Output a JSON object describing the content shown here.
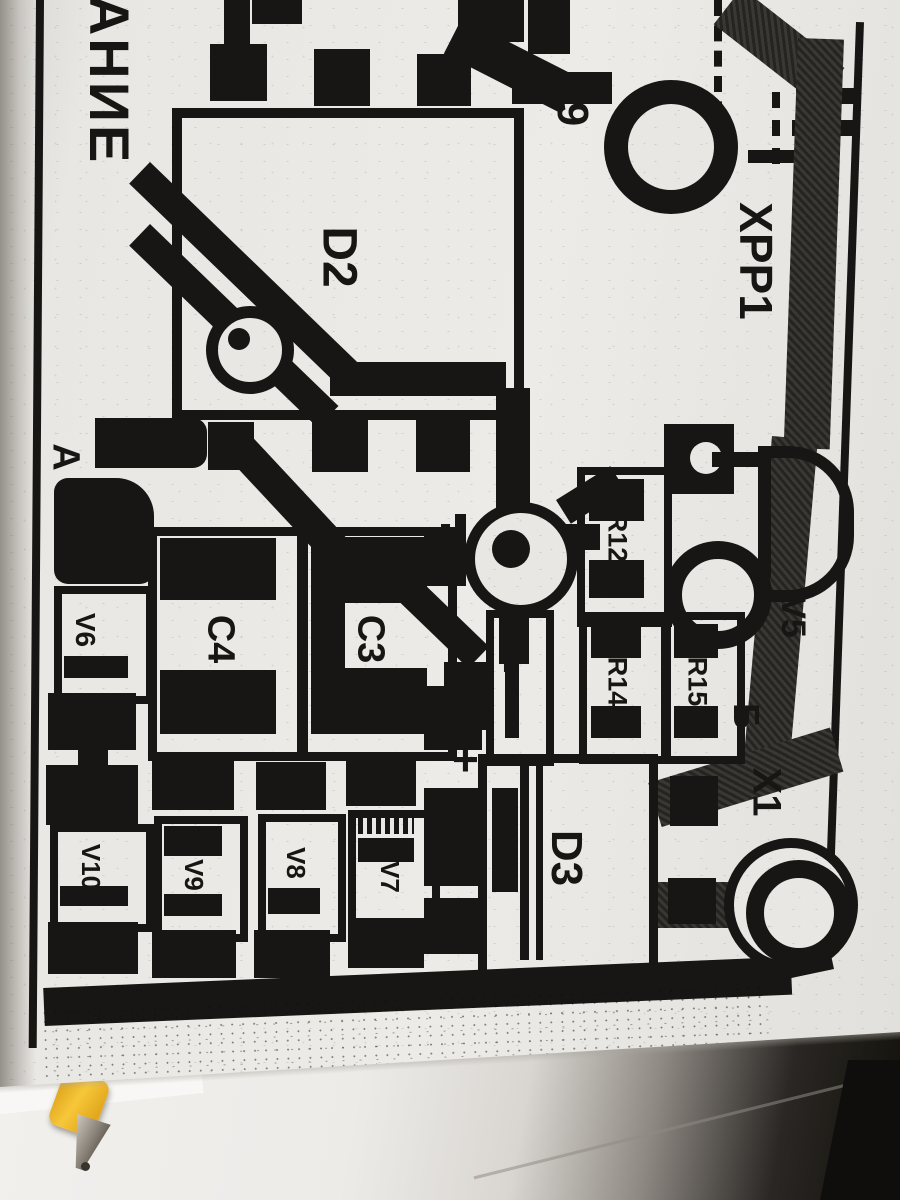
{
  "photo": {
    "subject": "printed circuit board layout, photocopied page, rotated 90 degrees",
    "colors": {
      "ink": "#181614",
      "paper": "#e9e7e3",
      "trace_gray": "#343230",
      "pen_yellow": "#f2b42d",
      "desk_dark": "#121009"
    }
  },
  "labels": {
    "power": "ПИТАНИЕ",
    "d2": "D2",
    "d3": "D3",
    "c3": "C3",
    "c4": "C4",
    "r12": "R12",
    "r3": "R3",
    "r14": "R14",
    "r15": "R15",
    "v5": "V5",
    "v6": "V6",
    "v7": "V7",
    "v8": "V8",
    "v9": "V9",
    "v10": "V10",
    "xpp1": "XPP1",
    "x1": "X1",
    "pin9": "9",
    "point_a": "A",
    "point_b": "Б",
    "plus": "+"
  }
}
